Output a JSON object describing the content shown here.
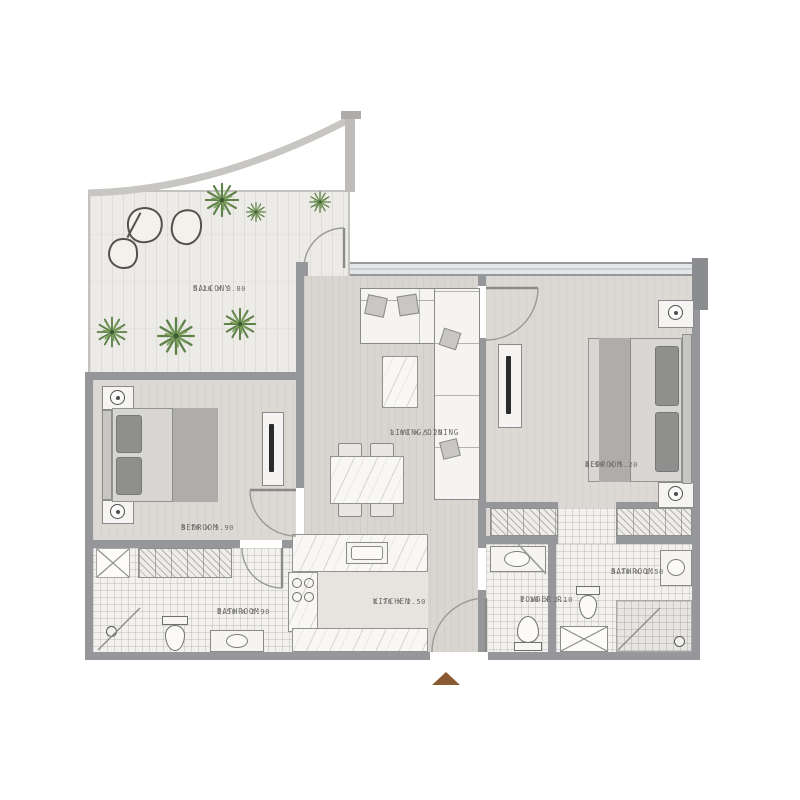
{
  "plan_type": "residential-apartment-floor-plan",
  "rooms": {
    "balcony": {
      "name": "BALCONY",
      "dims": "5.20 X 3.80"
    },
    "living_dining": {
      "name": "LIVING/DINING",
      "dims": "3.80 X 5.20"
    },
    "bedroom_left": {
      "name": "BEDROOM",
      "dims": "3.70 X 3.90"
    },
    "bedroom_right": {
      "name": "BEDROOM",
      "dims": "4.90 X 5.20"
    },
    "bathroom_left": {
      "name": "BATHROOM",
      "dims": "2.50 X 2.90"
    },
    "kitchen": {
      "name": "KITCHEN",
      "dims": "2.70 X 2.50"
    },
    "powder": {
      "name": "POWDER R.",
      "dims": "1.30 X 2.10"
    },
    "bathroom_right": {
      "name": "BATHROOM",
      "dims": "3.70 X 1.50"
    }
  },
  "colors": {
    "wall": "#96979a",
    "wall_dark": "#8a8c8f",
    "floor_plank": "#d9d5d0",
    "balcony_wood": "#edebe7",
    "tile": "#f2f1ee",
    "window_glass": "#e3e7ea",
    "plant_green": "#5e8049",
    "entry_marker": "#8a5a33",
    "label_text": "#6e6d6b"
  },
  "icons": {
    "entry_marker": "brown triangle at main entrance",
    "palm_plant": "green palm burst (balcony decor)",
    "stone": "organic boulder blob (balcony decor)"
  }
}
